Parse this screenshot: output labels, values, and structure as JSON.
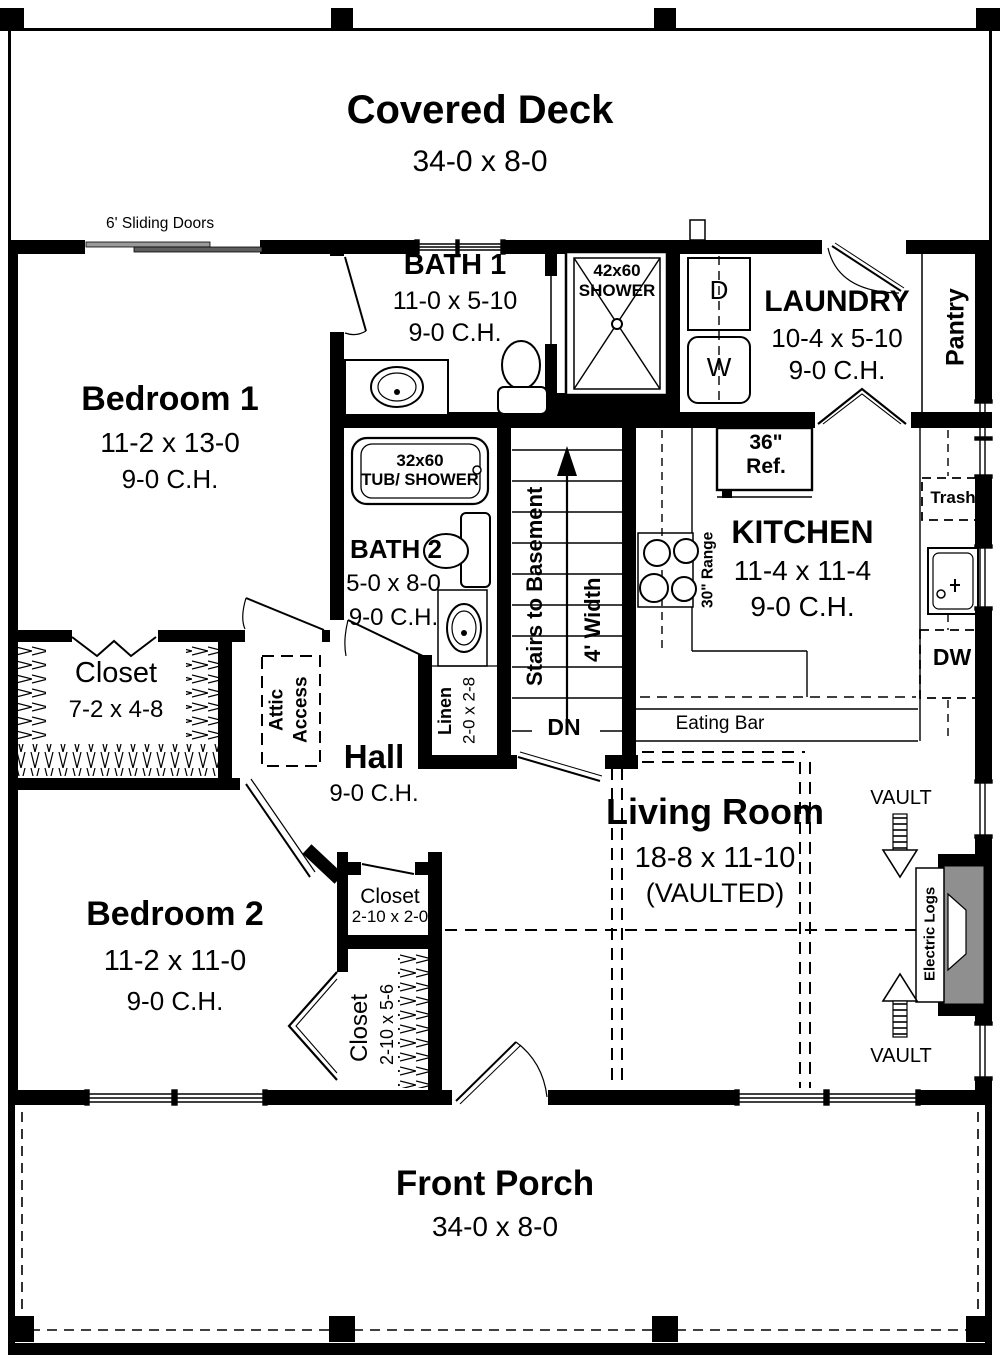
{
  "rooms": {
    "covered_deck": {
      "name": "Covered Deck",
      "dims": "34-0 x 8-0"
    },
    "sliding_doors_label": "6' Sliding Doors",
    "bedroom1": {
      "name": "Bedroom 1",
      "dims": "11-2 x 13-0",
      "ch": "9-0 C.H."
    },
    "bath1": {
      "name": "BATH 1",
      "dims": "11-0 x 5-10",
      "ch": "9-0 C.H."
    },
    "shower": {
      "size": "42x60",
      "label": "SHOWER"
    },
    "laundry": {
      "name": "LAUNDRY",
      "dims": "10-4 x 5-10",
      "ch": "9-0 C.H.",
      "dryer": "D",
      "washer": "W"
    },
    "pantry": {
      "name": "Pantry"
    },
    "tub": {
      "size": "32x60",
      "label": "TUB/ SHOWER"
    },
    "bath2": {
      "name": "BATH 2",
      "dims": "5-0 x 8-0",
      "ch": "9-0 C.H."
    },
    "stairs": {
      "label": "Stairs to Basement",
      "width": "4' Width",
      "dn": "DN"
    },
    "kitchen": {
      "name": "KITCHEN",
      "dims": "11-4 x 11-4",
      "ch": "9-0 C.H.",
      "ref_size": "36\"",
      "ref": "Ref.",
      "range": "30\" Range",
      "trash": "Trash",
      "dw": "DW",
      "eating_bar": "Eating Bar"
    },
    "hall_closet": {
      "name": "Closet",
      "dims": "7-2 x 4-8"
    },
    "attic": {
      "line1": "Attic",
      "line2": "Access"
    },
    "hall": {
      "name": "Hall",
      "ch": "9-0 C.H."
    },
    "linen": {
      "name": "Linen",
      "dims": "2-0 x 2-8"
    },
    "living": {
      "name": "Living Room",
      "dims": "18-8 x 11-10",
      "note": "(VAULTED)",
      "vault": "VAULT",
      "fireplace": "Electric Logs"
    },
    "bedroom2": {
      "name": "Bedroom 2",
      "dims": "11-2 x 11-0",
      "ch": "9-0 C.H."
    },
    "closet_small": {
      "name": "Closet",
      "dims": "2-10 x 2-0"
    },
    "closet_tall": {
      "name": "Closet",
      "dims": "2-10 x 5-6"
    },
    "front_porch": {
      "name": "Front Porch",
      "dims": "34-0 x 8-0"
    }
  },
  "colors": {
    "wall": "#000000",
    "fixture_gray": "#8f8f8f",
    "door_bar": "#8c8c8c"
  }
}
